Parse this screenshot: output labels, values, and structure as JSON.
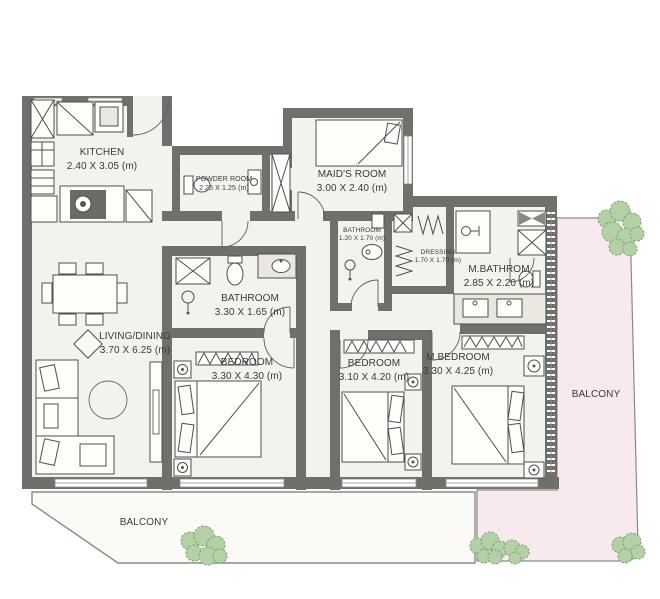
{
  "plan": {
    "rooms": {
      "kitchen": {
        "name": "KITCHEN",
        "dims": "2.40 X 3.05 (m)"
      },
      "powder": {
        "name": "POWDER ROOM",
        "dims": "2.25 X 1.25 (m)"
      },
      "maids": {
        "name": "MAID'S ROOM",
        "dims": "3.00 X 2.40 (m)"
      },
      "bathroom_small": {
        "name": "BATHROOM",
        "dims": "1.20 X 1.70 (m)"
      },
      "dressing": {
        "name": "DRESSING",
        "dims": "1.70 X 1.70 (m)"
      },
      "mbathroom": {
        "name": "M.BATHROM",
        "dims": "2.85 X 2.20 (m)"
      },
      "bathroom": {
        "name": "BATHROOM",
        "dims": "3.30 X 1.65 (m)"
      },
      "living": {
        "name": "LIVING/DINING",
        "dims": "3.70 X 6.25 (m)"
      },
      "bedroom1": {
        "name": "BEDROOM",
        "dims": "3.30 X 4.30 (m)"
      },
      "bedroom2": {
        "name": "BEDROOM",
        "dims": "3.10 X 4.20 (m)"
      },
      "mbedroom": {
        "name": "M.BEDROOM",
        "dims": "3.30 X 4.25 (m)"
      },
      "balcony_left": {
        "name": "BALCONY"
      },
      "balcony_right": {
        "name": "BALCONY"
      }
    },
    "colors": {
      "wall": "#716f6b",
      "floor": "#f3f2ec",
      "balcony": "#f8e9ee",
      "balconyLeft": "#fbfaf6",
      "plant": "#b3d0a6",
      "plantDark": "#7fa377",
      "line": "#4e4e4e",
      "text": "#3a3a3a"
    }
  }
}
